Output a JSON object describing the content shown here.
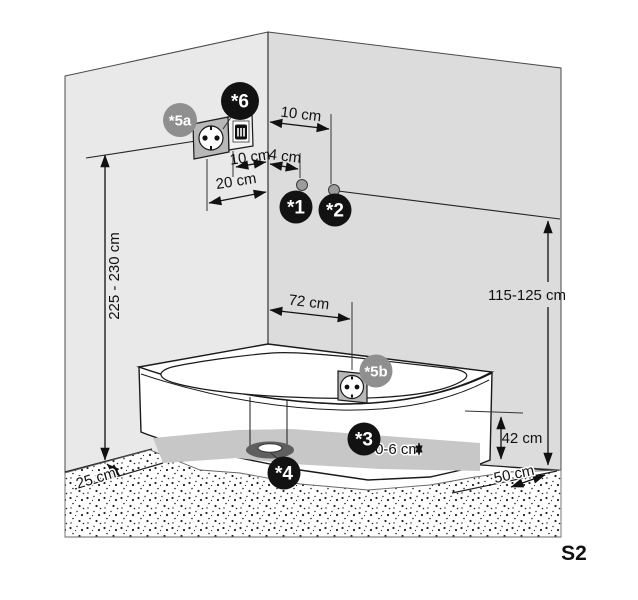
{
  "sheet": {
    "code": "S2"
  },
  "colors": {
    "red": "#e30613",
    "wall_left": "#e9e9e9",
    "wall_right": "#dcdcdc",
    "plinth_gray": "#c7c7c7",
    "badge_black": "#121212",
    "badge_gray": "#8f8f8f",
    "socket_frame": "#b8b8b8",
    "drain_gray": "#5f5f5f",
    "dot_gray": "#9c9c9c"
  },
  "badges": {
    "b1": "*1",
    "b2": "*2",
    "b3": "*3",
    "b4": "*4",
    "b5a": "*5a",
    "b5b": "*5b",
    "b6": "*6"
  },
  "dimensions": {
    "socket_box_to_corner": "10 cm",
    "corner_to_point1": "4 cm",
    "corner_to_point2": "10 cm",
    "socket_to_corner": "20 cm",
    "socket_height_range": "225 - 230 cm",
    "wall_height_range": "115-125 cm",
    "tub_socket_offset": "72 cm",
    "feet_adjust_range": "0-6 cm",
    "tub_height": "42 cm",
    "right_floor_clearance": "50 cm",
    "left_floor_clearance": "25 cm"
  }
}
